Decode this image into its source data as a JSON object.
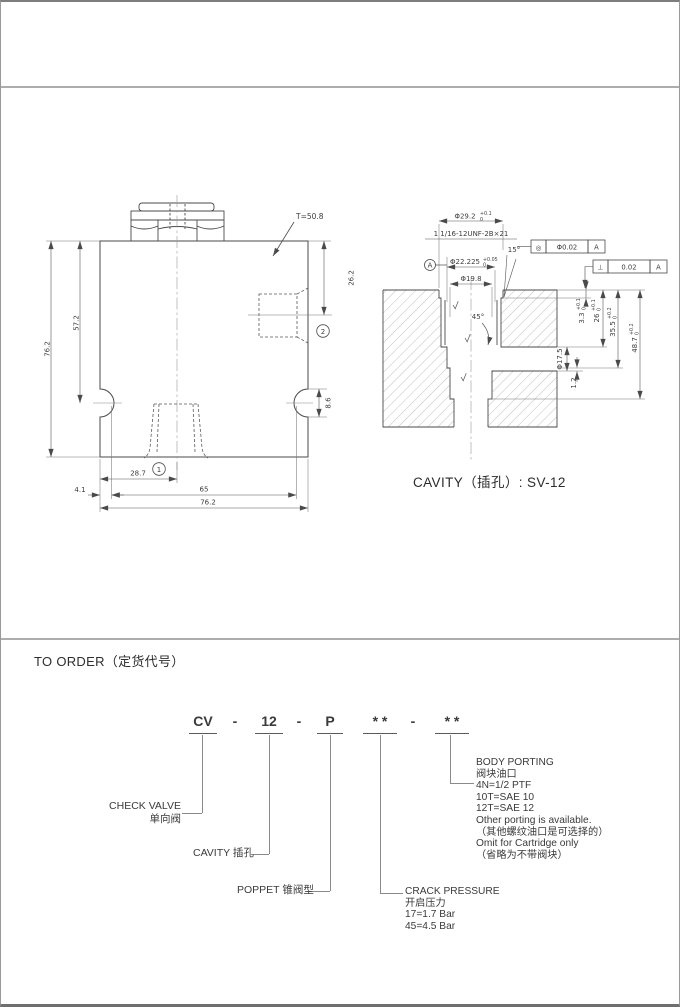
{
  "front_view": {
    "torque_note": "T=50.8",
    "marker_port1": "1",
    "marker_port2": "2",
    "dims": {
      "overall_height": "76.2",
      "body_height": "57.2",
      "port2_center": "26.2",
      "slot_width": "8.6",
      "port1_center": "28.7",
      "hole_edge_offset": "4.1",
      "hole_spacing": "65",
      "overall_width": "76.2"
    }
  },
  "cavity_view": {
    "caption": "CAVITY（插孔）: SV-12",
    "thread_spec": "1 1/16-12UNF-2B×21",
    "datum_label": "A",
    "angle_chamfer": "15°",
    "angle_seat": "45°",
    "fcf_concentricity": {
      "symbol": "◎",
      "tolerance": "Φ0.02",
      "datum": "A"
    },
    "fcf_perpendicularity": {
      "symbol": "⊥",
      "tolerance": "0.02",
      "datum": "A"
    },
    "dims": {
      "counterbore": {
        "v": "Φ29.2",
        "hi": "+0.1",
        "lo": "0"
      },
      "pilot_bore": {
        "v": "Φ22.225",
        "hi": "+0.05",
        "lo": "0"
      },
      "seat_bore": {
        "v": "Φ19.8"
      },
      "depth_counterbore": {
        "v": "3.3",
        "hi": "+0.1",
        "lo": "0"
      },
      "depth_thread": {
        "v": "26",
        "hi": "+0.1",
        "lo": "0"
      },
      "depth_pilot": {
        "v": "35.5",
        "hi": "+0.2",
        "lo": "0"
      },
      "depth_total": {
        "v": "48.7",
        "hi": "+0.2",
        "lo": "0"
      },
      "cross_port": {
        "v": "Φ17.5"
      },
      "land": {
        "v": "1.2"
      }
    }
  },
  "order": {
    "heading": "TO ORDER（定货代号）",
    "code": {
      "model": "CV",
      "sep1": "-",
      "size": "12",
      "sep2": "-",
      "poppet": "P",
      "crack": "* *",
      "sep3": "-",
      "porting": "* *"
    },
    "check_valve": {
      "en": "CHECK VALVE",
      "zh": "单向阀"
    },
    "cavity_label": "CAVITY 插孔",
    "poppet_label": "POPPET 锥阀型",
    "crack": {
      "title": "CRACK PRESSURE",
      "zh": "开启压力",
      "options": [
        "17=1.7 Bar",
        "45=4.5 Bar"
      ]
    },
    "porting": {
      "title": "BODY PORTING",
      "zh": "阀块油口",
      "options": [
        "4N=1/2 PTF",
        "10T=SAE 10",
        "12T=SAE 12"
      ],
      "notes": [
        "Other porting is available.",
        "（其他螺纹油口是可选择的）",
        "Omit for Cartridge only",
        "（省略为不带阀块）"
      ]
    }
  }
}
